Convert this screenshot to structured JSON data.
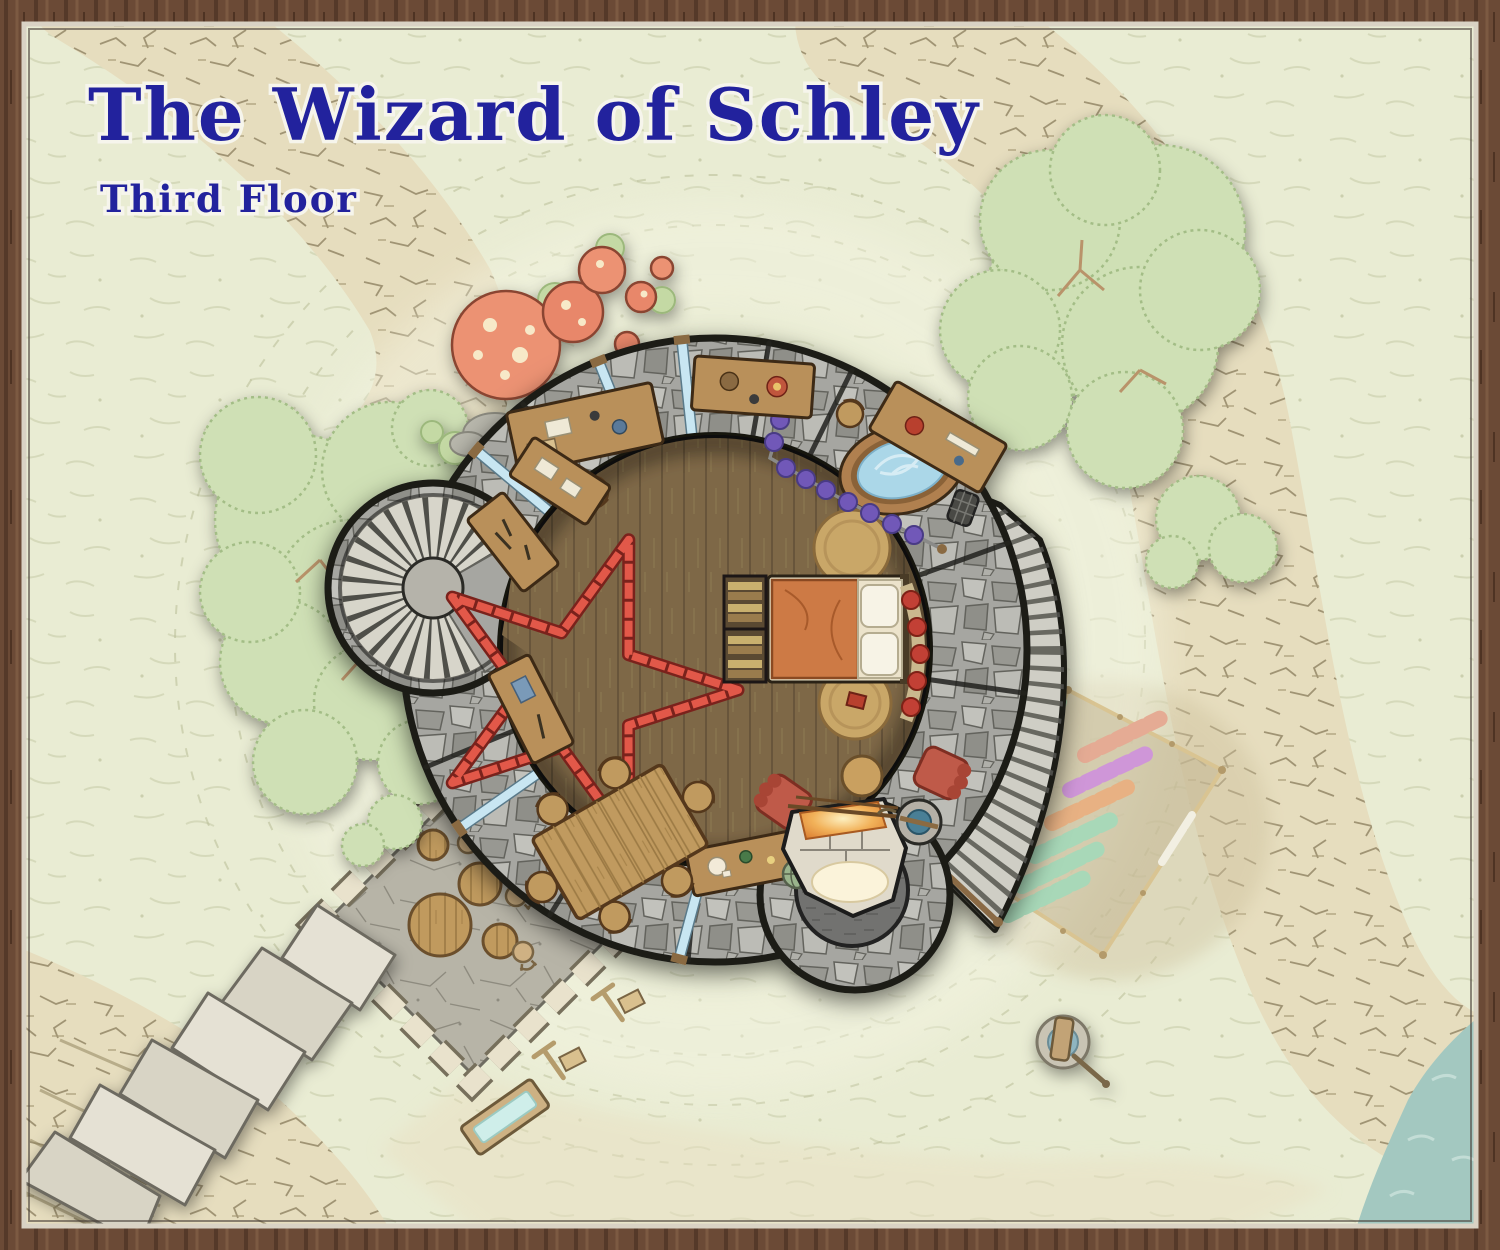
{
  "map": {
    "title": "The Wizard of Schley",
    "subtitle": "Third Floor"
  },
  "palette": {
    "title_ink": "#22229d",
    "parchment_green": "#e9ecd3",
    "cliff_tan": "#e6ddbe",
    "stone_gray": "#a6a6a1",
    "wood_floor_brown": "#7e6847",
    "sea_teal": "#a3c8c0",
    "pentagram_red": "#e25948",
    "tree_green": "#cfe0b5",
    "curtain_purple": "#7158b8",
    "water_blue": "#abd7e8"
  },
  "features": [
    "wizard-tower",
    "spiral-staircase-turret",
    "exterior-curved-staircase",
    "bedchamber-bed",
    "pentagram-floor-sigil",
    "wooden-bathtub",
    "privacy-curtain",
    "alchemy-desks",
    "dining-table",
    "armchairs",
    "fireplace-hearth",
    "interior-well",
    "chimney-turret",
    "courtyard-terrace",
    "stone-slab-steps",
    "water-trough",
    "hitching-posts",
    "herb-garden",
    "garden-water-pump",
    "giant-mushroom-grove",
    "tree-clusters",
    "cliff-ring",
    "sea-shore"
  ]
}
